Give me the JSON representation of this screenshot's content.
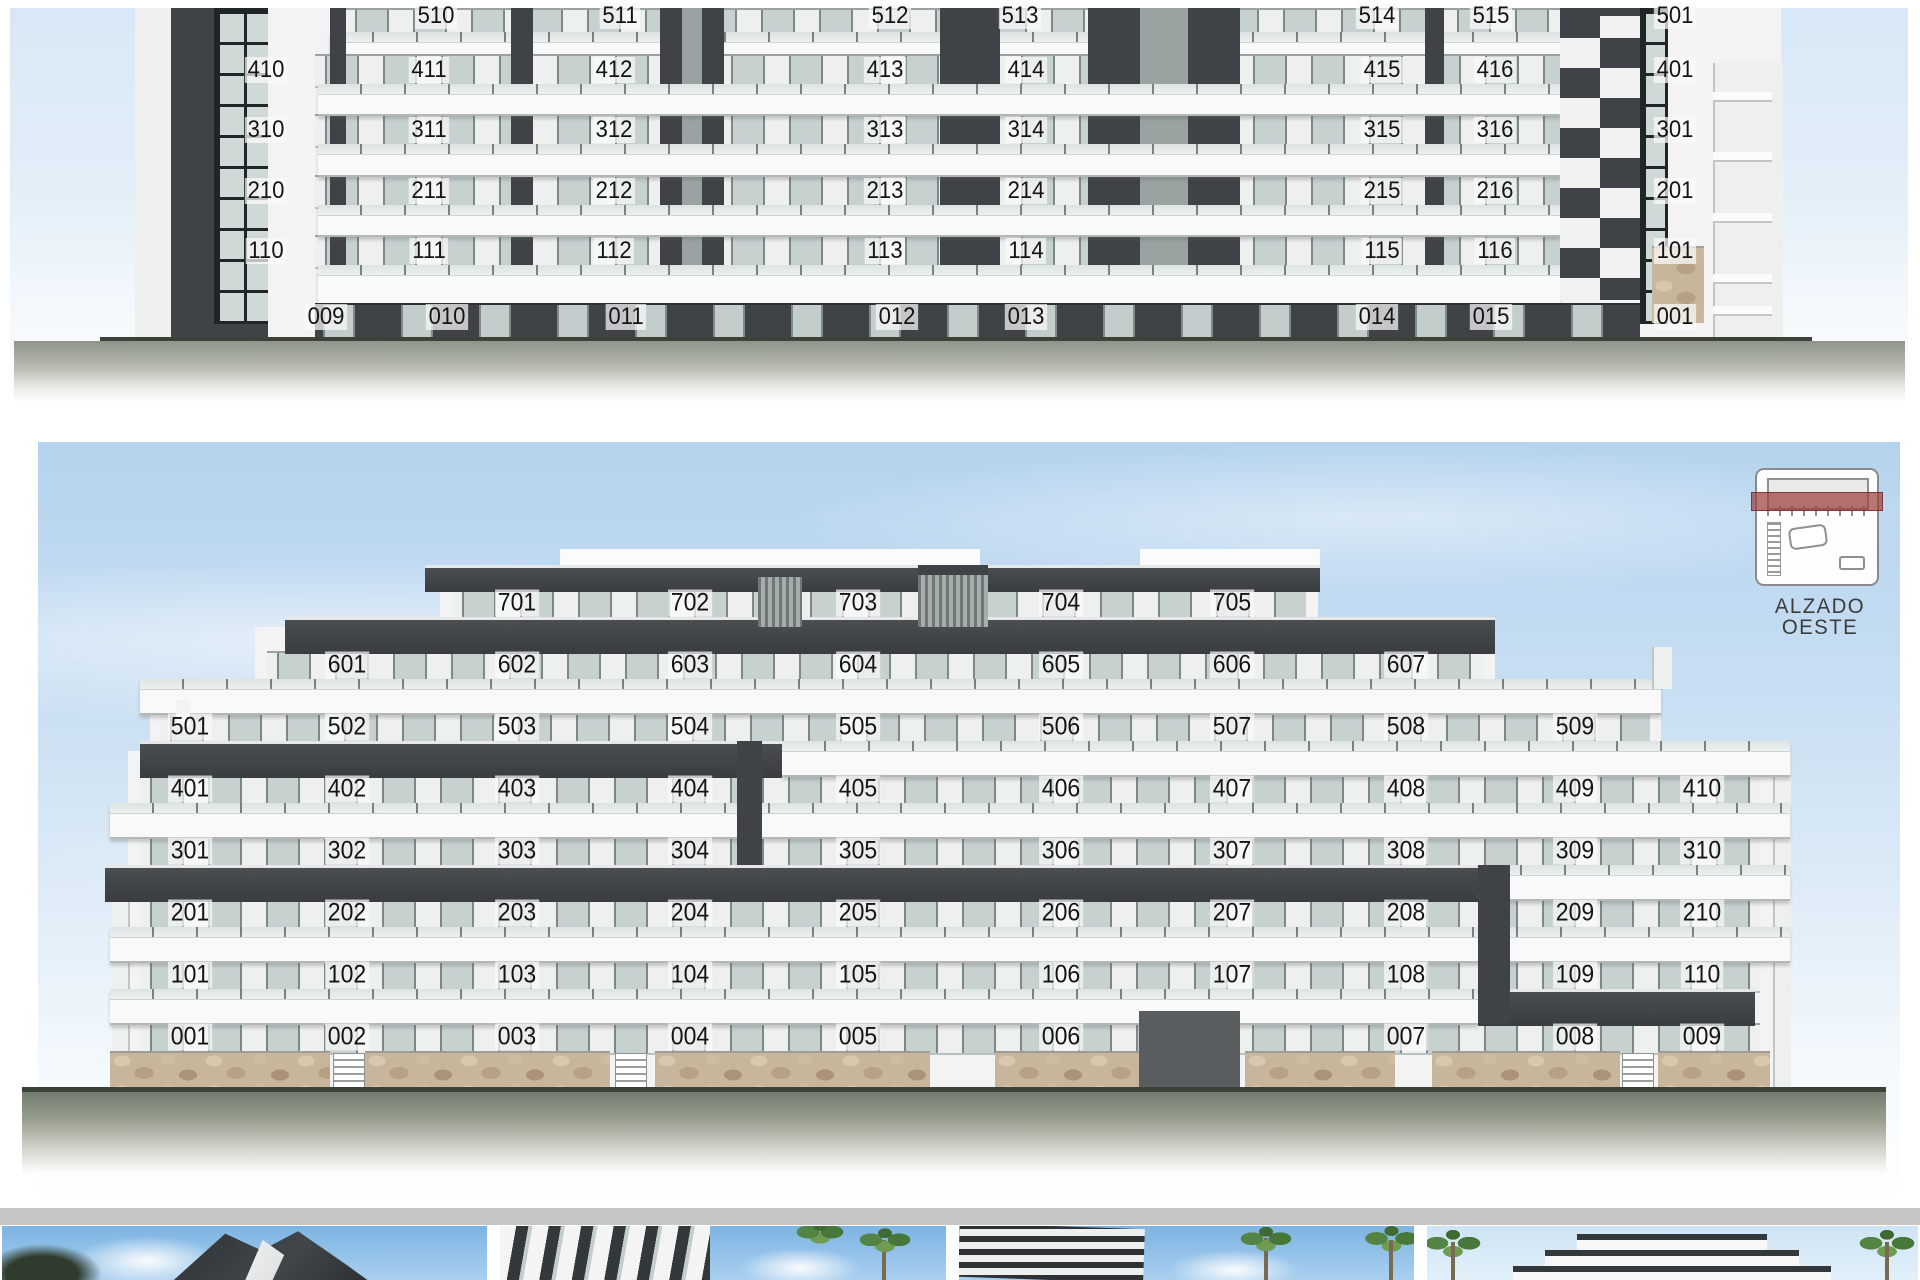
{
  "sheet": {
    "type": "architectural elevation sheet"
  },
  "top_elevation": {
    "floors": [
      {
        "name": "floor-5",
        "units": [
          "510",
          "511",
          "512",
          "513",
          "514",
          "515",
          "501"
        ]
      },
      {
        "name": "floor-4",
        "units": [
          "410",
          "411",
          "412",
          "413",
          "414",
          "415",
          "416",
          "401"
        ]
      },
      {
        "name": "floor-3",
        "units": [
          "310",
          "311",
          "312",
          "313",
          "314",
          "315",
          "316",
          "301"
        ]
      },
      {
        "name": "floor-2",
        "units": [
          "210",
          "211",
          "212",
          "213",
          "214",
          "215",
          "216",
          "201"
        ]
      },
      {
        "name": "floor-1",
        "units": [
          "110",
          "111",
          "112",
          "113",
          "114",
          "115",
          "116",
          "101"
        ]
      },
      {
        "name": "floor-0",
        "units": [
          "009",
          "010",
          "011",
          "012",
          "013",
          "014",
          "015",
          "001"
        ]
      }
    ]
  },
  "west_elevation": {
    "label": "ALZADO OESTE",
    "floors": [
      {
        "name": "floor-7",
        "units": [
          "701",
          "702",
          "703",
          "704",
          "705"
        ]
      },
      {
        "name": "floor-6",
        "units": [
          "601",
          "602",
          "603",
          "604",
          "605",
          "606",
          "607"
        ]
      },
      {
        "name": "floor-5",
        "units": [
          "501",
          "502",
          "503",
          "504",
          "505",
          "506",
          "507",
          "508",
          "509"
        ]
      },
      {
        "name": "floor-4",
        "units": [
          "401",
          "402",
          "403",
          "404",
          "405",
          "406",
          "407",
          "408",
          "409",
          "410"
        ]
      },
      {
        "name": "floor-3",
        "units": [
          "301",
          "302",
          "303",
          "304",
          "305",
          "306",
          "307",
          "308",
          "309",
          "310"
        ]
      },
      {
        "name": "floor-2",
        "units": [
          "201",
          "202",
          "203",
          "204",
          "205",
          "206",
          "207",
          "208",
          "209",
          "210"
        ]
      },
      {
        "name": "floor-1",
        "units": [
          "101",
          "102",
          "103",
          "104",
          "105",
          "106",
          "107",
          "108",
          "109",
          "110"
        ]
      },
      {
        "name": "floor-0",
        "units": [
          "001",
          "002",
          "003",
          "004",
          "005",
          "006",
          "007",
          "008",
          "009"
        ]
      }
    ]
  },
  "thumbnails": [
    {
      "description": "exterior render, dark angular building corner with sky"
    },
    {
      "description": "exterior render, white facade with dark window bands and palms"
    },
    {
      "description": "exterior render, dark balcony building with palm trees"
    },
    {
      "description": "exterior render, stepped building front with palms both sides"
    }
  ],
  "colors": {
    "sky_top": "#d8e8f6",
    "sky_west": "#b5d3ee",
    "charcoal": "#3f4347",
    "glass": "#c6d1d0",
    "stone": "#c8b69c",
    "ground": "#8f958a",
    "keyplan_highlight": "#9b403e",
    "label_text": "#3c3c3c"
  }
}
